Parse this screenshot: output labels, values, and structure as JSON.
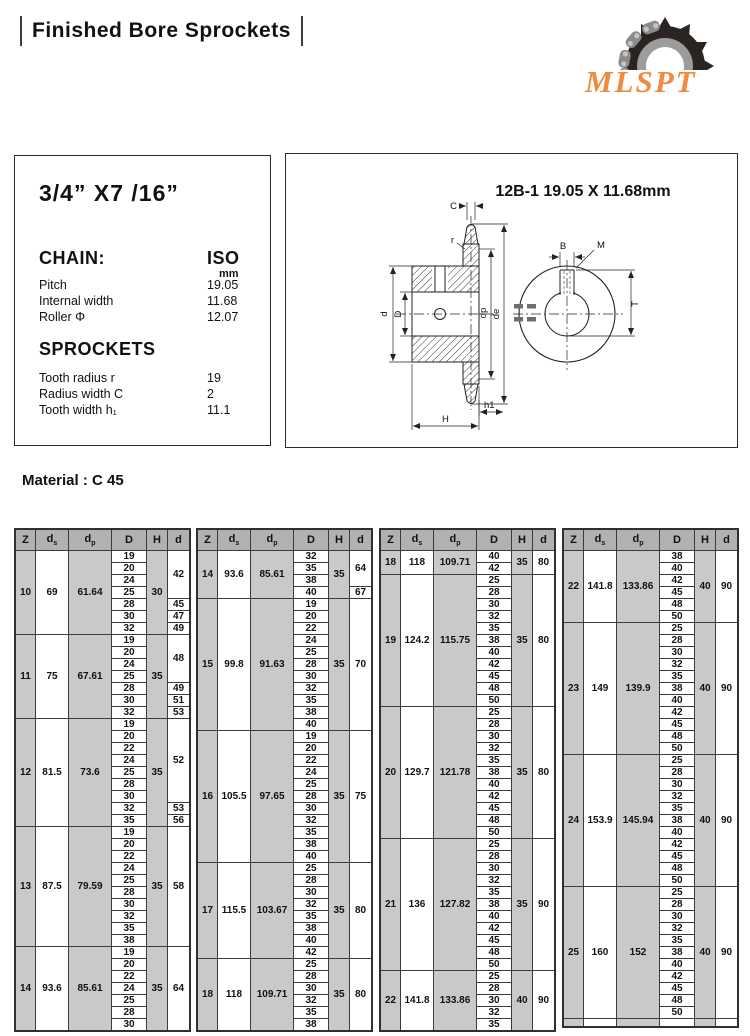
{
  "header": {
    "title": "Finished Bore Sprockets",
    "logo_text": "MLSPT",
    "logo_color": "#f08a3c"
  },
  "spec_panel": {
    "size_title": "3/4” X7 /16”",
    "chain_heading": "CHAIN:",
    "unit_heading": "ISO",
    "unit_sub": "mm",
    "chain_rows": [
      {
        "label": "Pitch",
        "value": "19.05"
      },
      {
        "label": "Internal width",
        "value": "11.68"
      },
      {
        "label": "Roller Φ",
        "value": "12.07"
      }
    ],
    "sprockets_heading": "SPROCKETS",
    "sprocket_rows": [
      {
        "label": "Tooth radius r",
        "value": "19"
      },
      {
        "label": "Radius width C",
        "value": "2"
      },
      {
        "label": "Tooth width h₁",
        "value": "11.1"
      }
    ]
  },
  "drawing_panel": {
    "title": "12B-1 19.05 X 11.68mm",
    "labels": {
      "c": "C",
      "r": "r",
      "b": "B",
      "m": "M",
      "d": "d",
      "D": "D",
      "dp": "dp",
      "de": "de",
      "t": "T",
      "h1": "h1",
      "h": "H"
    }
  },
  "material_label": "Material : C 45",
  "table_headers": [
    "Z",
    "d_s",
    "d_p",
    "D",
    "H",
    "d"
  ],
  "tables": [
    {
      "groups": [
        {
          "z": "10",
          "ds": "69",
          "dp": "61.64",
          "h": "30",
          "d_cells": [
            {
              "bores": [
                "19",
                "20",
                "24",
                "25"
              ],
              "d": "42"
            },
            {
              "bores": [
                "28"
              ],
              "d": "45"
            },
            {
              "bores": [
                "30"
              ],
              "d": "47"
            },
            {
              "bores": [
                "32"
              ],
              "d": "49"
            }
          ]
        },
        {
          "z": "11",
          "ds": "75",
          "dp": "67.61",
          "h": "35",
          "d_cells": [
            {
              "bores": [
                "19",
                "20",
                "24",
                "25"
              ],
              "d": "48"
            },
            {
              "bores": [
                "28"
              ],
              "d": "49"
            },
            {
              "bores": [
                "30"
              ],
              "d": "51"
            },
            {
              "bores": [
                "32"
              ],
              "d": "53"
            }
          ]
        },
        {
          "z": "12",
          "ds": "81.5",
          "dp": "73.6",
          "h": "35",
          "d_cells": [
            {
              "bores": [
                "19",
                "20",
                "22",
                "24",
                "25",
                "28",
                "30"
              ],
              "d": "52"
            },
            {
              "bores": [
                "32"
              ],
              "d": "53"
            },
            {
              "bores": [
                "35"
              ],
              "d": "56"
            }
          ]
        },
        {
          "z": "13",
          "ds": "87.5",
          "dp": "79.59",
          "h": "35",
          "d_cells": [
            {
              "bores": [
                "19",
                "20",
                "22",
                "24",
                "25",
                "28",
                "30",
                "32",
                "35",
                "38"
              ],
              "d": "58"
            }
          ]
        },
        {
          "z": "14",
          "ds": "93.6",
          "dp": "85.61",
          "h": "35",
          "d_cells": [
            {
              "bores": [
                "19",
                "20",
                "22",
                "24",
                "25",
                "28",
                "30"
              ],
              "d": "64"
            }
          ]
        }
      ]
    },
    {
      "groups": [
        {
          "z": "14",
          "ds": "93.6",
          "dp": "85.61",
          "h": "35",
          "d_cells": [
            {
              "bores": [
                "32",
                "35",
                "38"
              ],
              "d": "64"
            },
            {
              "bores": [
                "40"
              ],
              "d": "67"
            }
          ]
        },
        {
          "z": "15",
          "ds": "99.8",
          "dp": "91.63",
          "h": "35",
          "d_cells": [
            {
              "bores": [
                "19",
                "20",
                "22",
                "24",
                "25",
                "28",
                "30",
                "32",
                "35",
                "38",
                "40"
              ],
              "d": "70"
            }
          ]
        },
        {
          "z": "16",
          "ds": "105.5",
          "dp": "97.65",
          "h": "35",
          "d_cells": [
            {
              "bores": [
                "19",
                "20",
                "22",
                "24",
                "25",
                "28",
                "30",
                "32",
                "35",
                "38",
                "40"
              ],
              "d": "75"
            }
          ]
        },
        {
          "z": "17",
          "ds": "115.5",
          "dp": "103.67",
          "h": "35",
          "d_cells": [
            {
              "bores": [
                "25",
                "28",
                "30",
                "32",
                "35",
                "38",
                "40",
                "42"
              ],
              "d": "80"
            }
          ]
        },
        {
          "z": "18",
          "ds": "118",
          "dp": "109.71",
          "h": "35",
          "d_cells": [
            {
              "bores": [
                "25",
                "28",
                "30",
                "32",
                "35",
                "38"
              ],
              "d": "80"
            }
          ]
        }
      ]
    },
    {
      "groups": [
        {
          "z": "18",
          "ds": "118",
          "dp": "109.71",
          "h": "35",
          "d_cells": [
            {
              "bores": [
                "40",
                "42"
              ],
              "d": "80"
            }
          ]
        },
        {
          "z": "19",
          "ds": "124.2",
          "dp": "115.75",
          "h": "35",
          "d_cells": [
            {
              "bores": [
                "25",
                "28",
                "30",
                "32",
                "35",
                "38",
                "40",
                "42",
                "45",
                "48",
                "50"
              ],
              "d": "80"
            }
          ]
        },
        {
          "z": "20",
          "ds": "129.7",
          "dp": "121.78",
          "h": "35",
          "d_cells": [
            {
              "bores": [
                "25",
                "28",
                "30",
                "32",
                "35",
                "38",
                "40",
                "42",
                "45",
                "48",
                "50"
              ],
              "d": "80"
            }
          ]
        },
        {
          "z": "21",
          "ds": "136",
          "dp": "127.82",
          "h": "35",
          "d_cells": [
            {
              "bores": [
                "25",
                "28",
                "30",
                "32",
                "35",
                "38",
                "40",
                "42",
                "45",
                "48",
                "50"
              ],
              "d": "90"
            }
          ]
        },
        {
          "z": "22",
          "ds": "141.8",
          "dp": "133.86",
          "h": "40",
          "d_cells": [
            {
              "bores": [
                "25",
                "28",
                "30",
                "32",
                "35"
              ],
              "d": "90"
            }
          ]
        }
      ]
    },
    {
      "footer_strip": true,
      "groups": [
        {
          "z": "22",
          "ds": "141.8",
          "dp": "133.86",
          "h": "40",
          "d_cells": [
            {
              "bores": [
                "38",
                "40",
                "42",
                "45",
                "48",
                "50"
              ],
              "d": "90"
            }
          ]
        },
        {
          "z": "23",
          "ds": "149",
          "dp": "139.9",
          "h": "40",
          "d_cells": [
            {
              "bores": [
                "25",
                "28",
                "30",
                "32",
                "35",
                "38",
                "40",
                "42",
                "45",
                "48",
                "50"
              ],
              "d": "90"
            }
          ]
        },
        {
          "z": "24",
          "ds": "153.9",
          "dp": "145.94",
          "h": "40",
          "d_cells": [
            {
              "bores": [
                "25",
                "28",
                "30",
                "32",
                "35",
                "38",
                "40",
                "42",
                "45",
                "48",
                "50"
              ],
              "d": "90"
            }
          ]
        },
        {
          "z": "25",
          "ds": "160",
          "dp": "152",
          "h": "40",
          "d_cells": [
            {
              "bores": [
                "25",
                "28",
                "30",
                "32",
                "35",
                "38",
                "40",
                "42",
                "45",
                "48",
                "50"
              ],
              "d": "90"
            }
          ]
        }
      ]
    }
  ]
}
